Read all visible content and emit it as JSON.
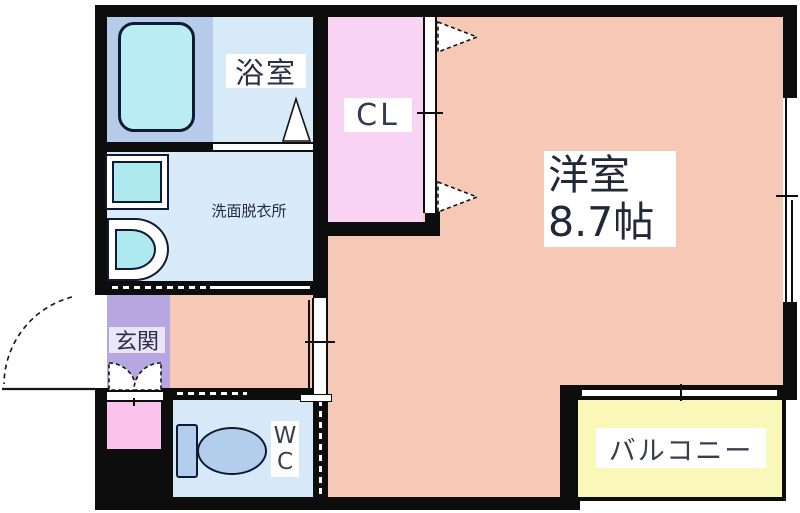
{
  "floor_plan": {
    "rooms": {
      "bathroom": {
        "label": "浴室"
      },
      "washroom": {
        "label": "洗面脱衣所"
      },
      "closet": {
        "label": "CL"
      },
      "main_room": {
        "label": "洋室",
        "size": "8.7帖"
      },
      "entrance": {
        "label": "玄関"
      },
      "toilet": {
        "letters": [
          "W",
          "C"
        ]
      },
      "balcony": {
        "label": "バルコニー"
      }
    },
    "colors": {
      "wall": "#0d0d0d",
      "main_room": "#f6c9b7",
      "closet": "#f8d3f3",
      "bathroom_floor": "#d8e9f7",
      "bathtub_pad": "#b6cbe9",
      "bathtub": "#b8eef3",
      "washroom": "#d9eaf8",
      "fixture_cyan": "#aee9ef",
      "entrance": "#b7a7e0",
      "entrance_cabinet": "#f9c2ea",
      "wc": "#d7e9f8",
      "toilet": "#b3cdec",
      "balcony": "#faf7b9"
    }
  }
}
